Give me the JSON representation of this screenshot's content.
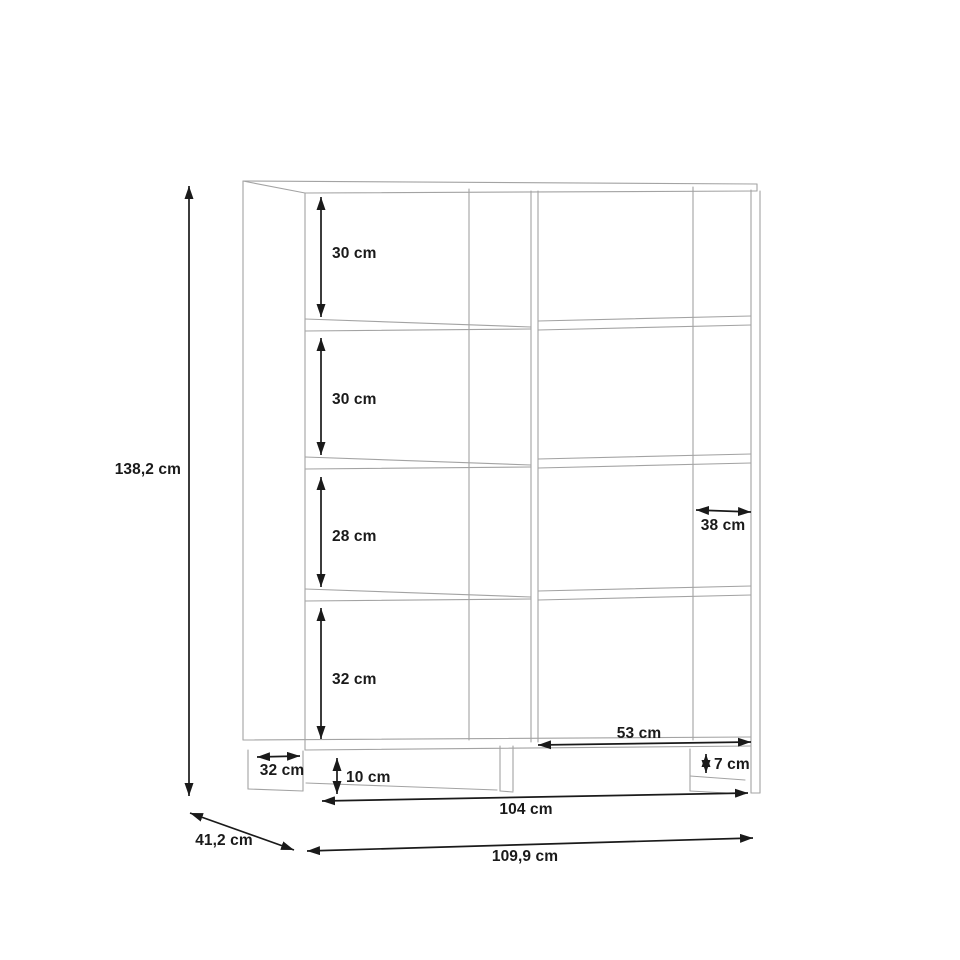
{
  "drawing": {
    "title": "bookcase-dimension-diagram",
    "background_color": "#ffffff",
    "cabinet_line_color": "#a3a3a3",
    "dimension_color": "#1a1a1a",
    "unit": "cm",
    "dimensions": {
      "total_height": {
        "label": "138,2 cm"
      },
      "total_depth": {
        "label": "41,2 cm"
      },
      "total_width": {
        "label": "109,9 cm"
      },
      "inner_width": {
        "label": "104 cm"
      },
      "compartment_1_height": {
        "label": "30 cm"
      },
      "compartment_2_height": {
        "label": "30 cm"
      },
      "compartment_3_height": {
        "label": "28 cm"
      },
      "compartment_4_height": {
        "label": "32 cm"
      },
      "shelf_depth": {
        "label": "38 cm"
      },
      "right_compartment_width": {
        "label": "53 cm"
      },
      "base_foot_depth": {
        "label": "32 cm"
      },
      "base_height": {
        "label": "10 cm"
      },
      "plinth_rail_height": {
        "label": "7 cm"
      }
    }
  }
}
